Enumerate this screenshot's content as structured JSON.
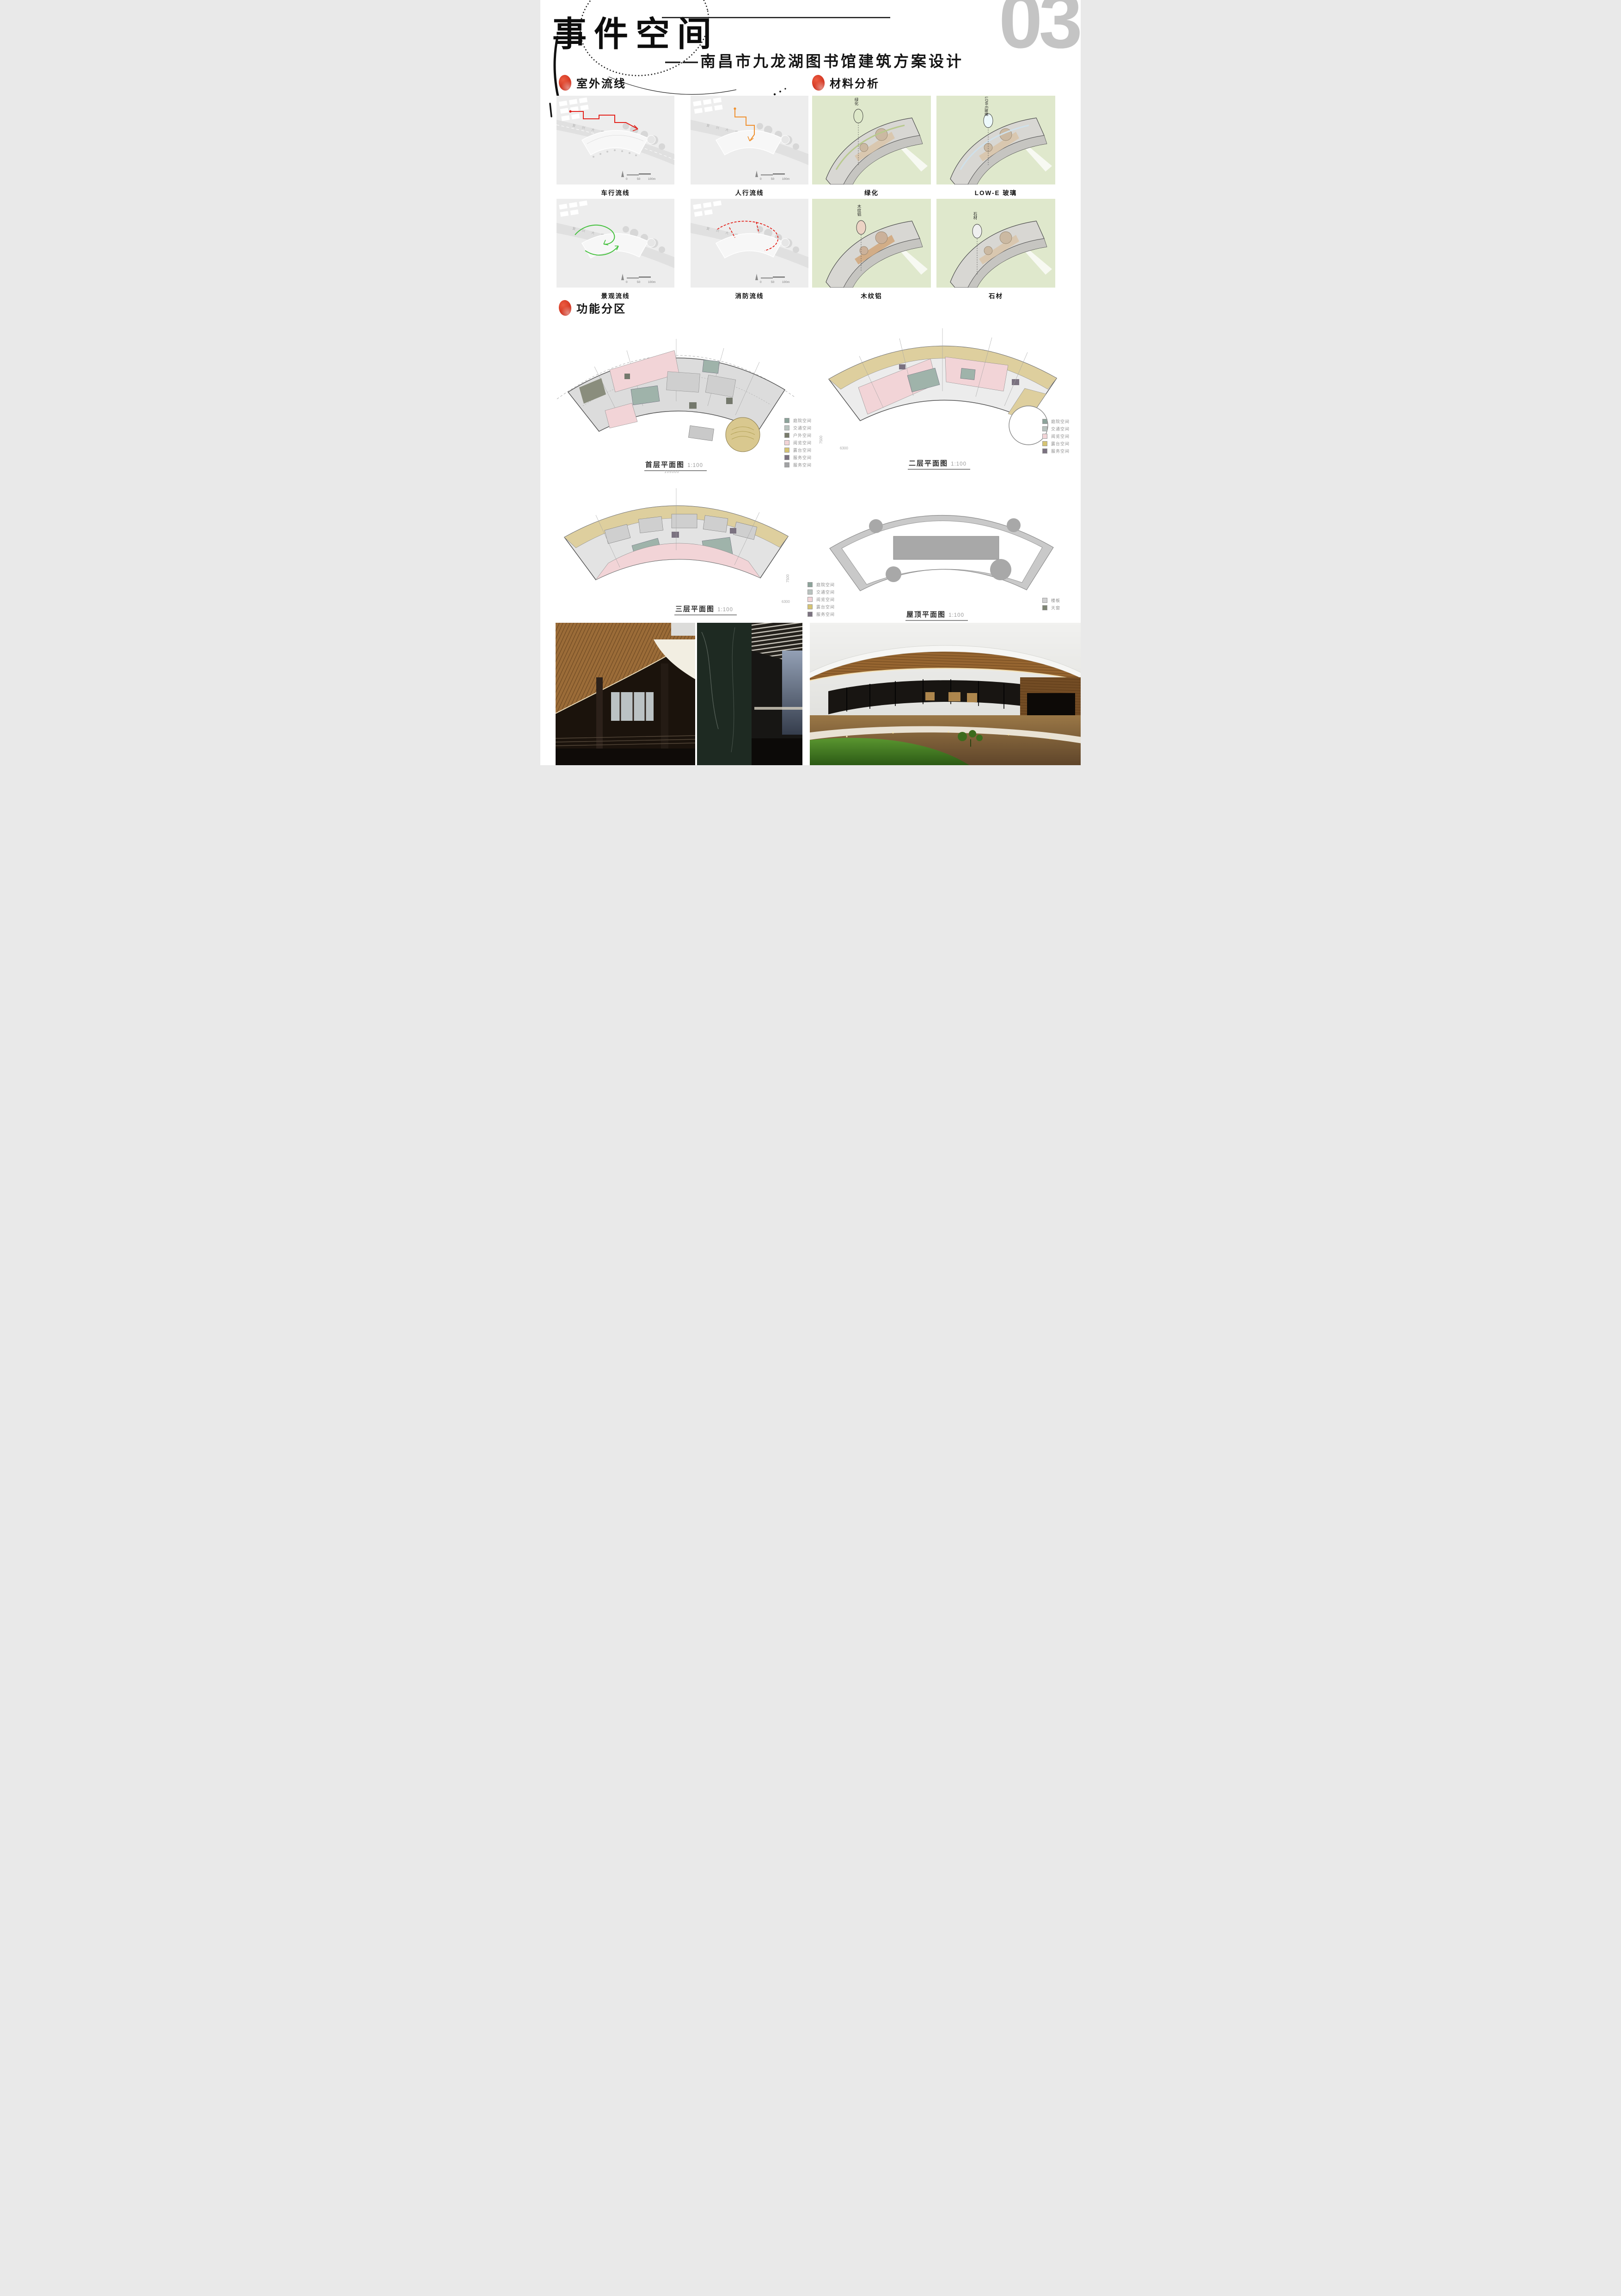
{
  "page": {
    "number": "03"
  },
  "header": {
    "title": "事件空间",
    "subtitle": "——南昌市九龙湖图书馆建筑方案设计"
  },
  "outdoor": {
    "heading": "室外流线",
    "plans": [
      {
        "label": "车行流线"
      },
      {
        "label": "人行流线"
      },
      {
        "label": "景观流线"
      },
      {
        "label": "消防流线"
      }
    ],
    "scalebar": {
      "v0": "0",
      "v50": "50",
      "v100": "100m"
    },
    "road_name": "复兴大道西"
  },
  "materials": {
    "heading": "材料分析",
    "items": [
      {
        "caption": "绿化",
        "balloon": "绿化",
        "swatch": "#dde8c8"
      },
      {
        "caption": "LOW-E 玻璃",
        "balloon": "LOW-E玻璃",
        "swatch": "#edf9fb"
      },
      {
        "caption": "木纹铝",
        "balloon": "木纹铝",
        "swatch": "#ecd3c4"
      },
      {
        "caption": "石材",
        "balloon": "石材",
        "swatch": "#efefef"
      }
    ],
    "panel_bg": "#dfe8cc"
  },
  "zoning": {
    "heading": "功能分区",
    "plans": [
      {
        "caption": "首层平面图",
        "scale": "1:100",
        "dim": "105000"
      },
      {
        "caption": "二层平面图",
        "scale": "1:100",
        "dim_a": "7500",
        "dim_b": "6300"
      },
      {
        "caption": "三层平面图",
        "scale": "1:100",
        "dim_a": "7500",
        "dim_b": "6300"
      },
      {
        "caption": "屋顶平面图",
        "scale": "1:100"
      }
    ],
    "legend_floor1": [
      {
        "label": "庭院空间",
        "color": "#8ca39a"
      },
      {
        "label": "交通空间",
        "color": "#b9c3bf"
      },
      {
        "label": "户外空间",
        "color": "#787b6b"
      },
      {
        "label": "阅览空间",
        "color": "#f2d4d7"
      },
      {
        "label": "露台空间",
        "color": "#d6c474"
      },
      {
        "label": "服务空间",
        "color": "#7b7280"
      },
      {
        "label": "服务空间",
        "color": "#a1a2a4"
      }
    ],
    "legend_floor23": [
      {
        "label": "庭院空间",
        "color": "#8ca39a"
      },
      {
        "label": "交通空间",
        "color": "#b9c3bf"
      },
      {
        "label": "阅览空间",
        "color": "#f2d4d7"
      },
      {
        "label": "露台空间",
        "color": "#d6c474"
      },
      {
        "label": "服务空间",
        "color": "#7b7280"
      }
    ],
    "legend_roof": [
      {
        "label": "楼板",
        "color": "#d0d0d1"
      },
      {
        "label": "天窗",
        "color": "#7e8574"
      }
    ]
  }
}
